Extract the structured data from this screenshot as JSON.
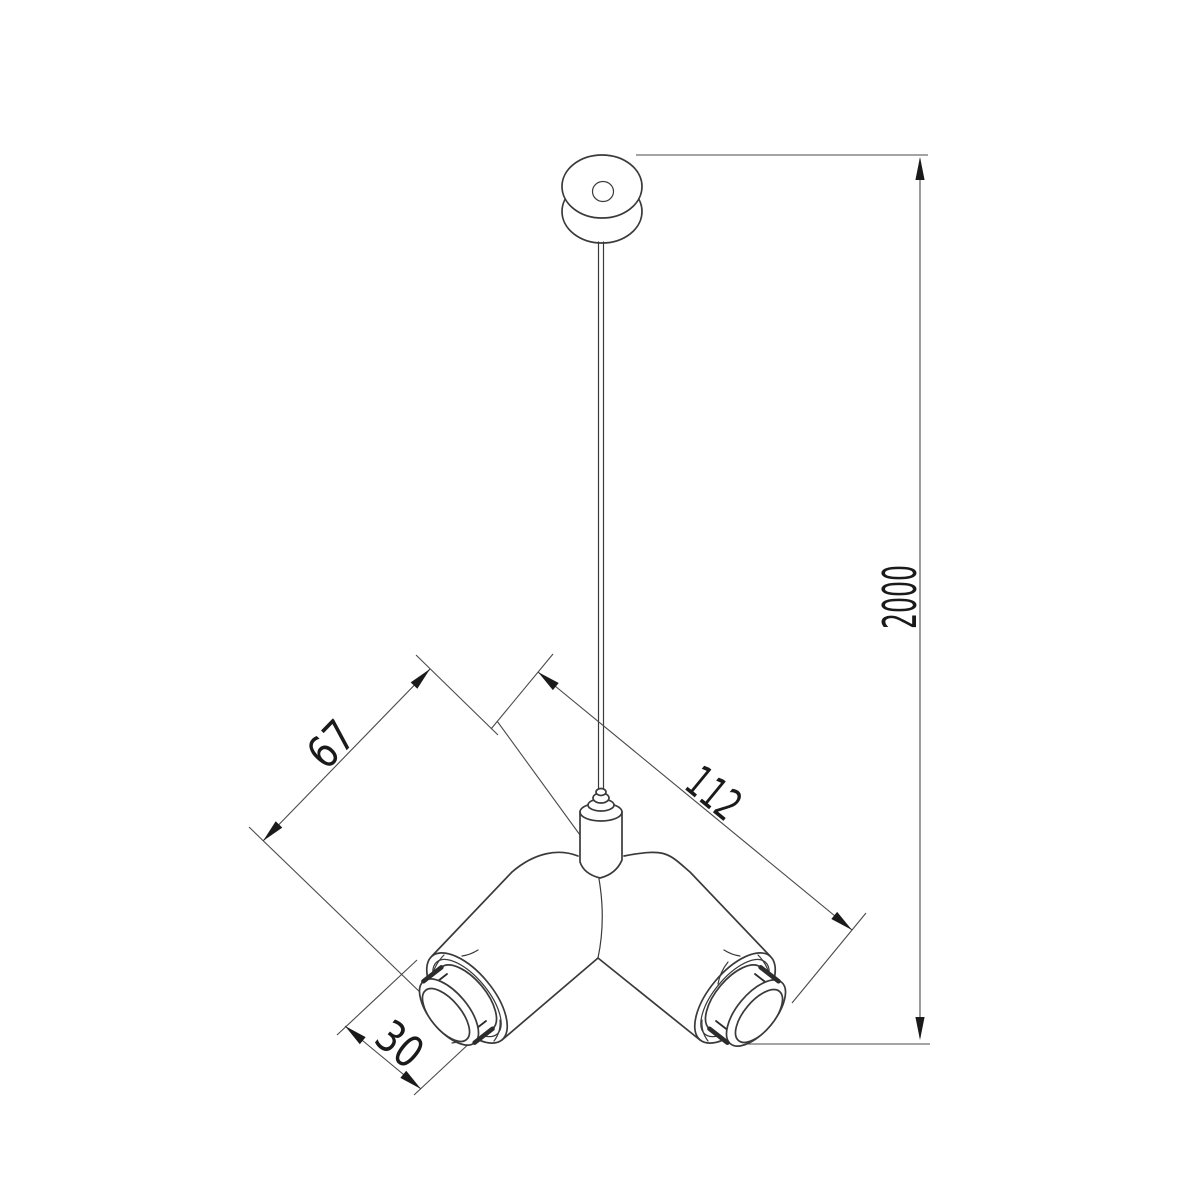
{
  "drawing": {
    "subject": "pendant-twin-spotlight-dimension-drawing",
    "dimensions": {
      "cable_drop": "2000",
      "body_length": "112",
      "arm_length": "67",
      "lens_depth": "30"
    },
    "colors": {
      "line": "#3a3a3a",
      "text": "#1a1a1a",
      "background": "#ffffff"
    }
  }
}
